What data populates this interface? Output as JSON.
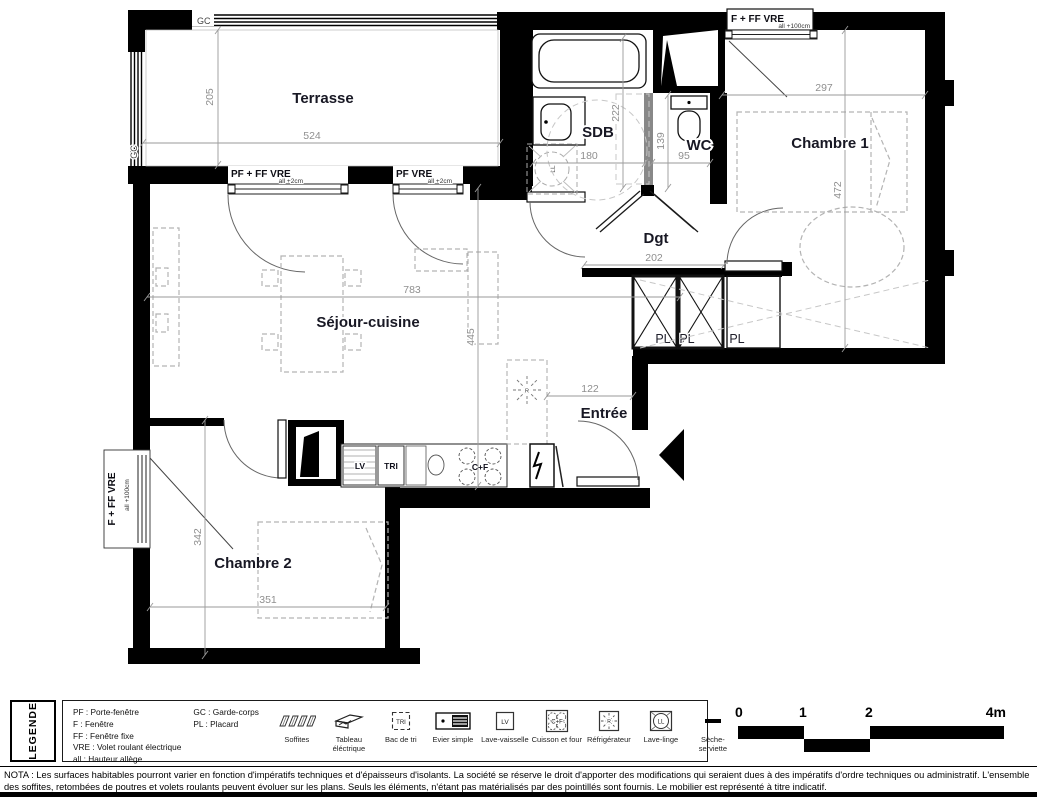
{
  "plan": {
    "rooms": {
      "terrasse": "Terrasse",
      "sdb": "SDB",
      "wc": "WC",
      "chambre1": "Chambre 1",
      "dgt": "Dgt",
      "sejour": "Séjour-cuisine",
      "entree": "Entrée",
      "chambre2": "Chambre 2"
    },
    "dims": {
      "terrasse_w": "524",
      "terrasse_h": "205",
      "sdb_w": "180",
      "sdb_h": "222",
      "wc_w": "95",
      "wc_h": "139",
      "chambre1_w": "297",
      "chambre1_h": "472",
      "sejour_w": "783",
      "sejour_h": "445",
      "dgt_w": "202",
      "entree_w": "122",
      "chambre2_w": "351",
      "chambre2_h": "342"
    },
    "windows": {
      "terrasse_left": {
        "label": "PF + FF  VRE",
        "sub": "all +2cm"
      },
      "terrasse_right": {
        "label": "PF VRE",
        "sub": "all +2cm"
      },
      "chambre1": {
        "label": "F + FF  VRE",
        "sub": "all +100cm"
      },
      "chambre2": {
        "label": "F + FF  VRE",
        "sub": "all +100cm"
      }
    },
    "railing": {
      "top": "GC",
      "left": "GC"
    },
    "placards": [
      "PL",
      "PL",
      "PL"
    ],
    "appliances": {
      "dishwasher": "LV",
      "recycling": "TRI",
      "cooktop": "C+F",
      "washer": "LL",
      "fridge": "R"
    }
  },
  "legend": {
    "title": "LEGENDE",
    "abbreviations_col1": [
      "PF : Porte-fenêtre",
      "F : Fenêtre",
      "FF : Fenêtre fixe",
      "VRE : Volet roulant électrique",
      "all : Hauteur allège"
    ],
    "abbreviations_col2": [
      "GC : Garde-corps",
      "PL : Placard"
    ],
    "items": [
      {
        "icon": "soffites-icon",
        "label": "Soffites",
        "glyph": ""
      },
      {
        "icon": "electrical-panel-icon",
        "label": "Tableau éléctrique",
        "glyph": ""
      },
      {
        "icon": "recycling-bin-icon",
        "label": "Bac de tri",
        "glyph": "TRI"
      },
      {
        "icon": "sink-icon",
        "label": "Evier simple",
        "glyph": ""
      },
      {
        "icon": "dishwasher-icon",
        "label": "Lave-vaisselle",
        "glyph": "LV"
      },
      {
        "icon": "stove-oven-icon",
        "label": "Cuisson et four",
        "glyph": "C+F"
      },
      {
        "icon": "fridge-icon",
        "label": "Réfrigérateur",
        "glyph": "R"
      },
      {
        "icon": "washing-machine-icon",
        "label": "Lave-linge",
        "glyph": "LL"
      },
      {
        "icon": "towel-dryer-icon",
        "label": "Sèche-serviette",
        "glyph": ""
      }
    ],
    "scale": {
      "ticks": [
        "0",
        "1",
        "2",
        "4m"
      ]
    }
  },
  "nota": {
    "line1": "NOTA : Les surfaces habitables pourront varier en fonction d'impératifs techniques et d'épaisseurs d'isolants. La société se réserve le droit d'apporter des modifications qui seraient dues à des impératifs d'ordre techniques ou administratif. L'ensemble",
    "line2": "des soffites, retombées de poutres et volets roulants peuvent évoluer sur les plans. Seuls les éléments, n'étant pas matérialisés par des pointillés sont fournis. Le mobilier est représenté à titre indicatif."
  }
}
